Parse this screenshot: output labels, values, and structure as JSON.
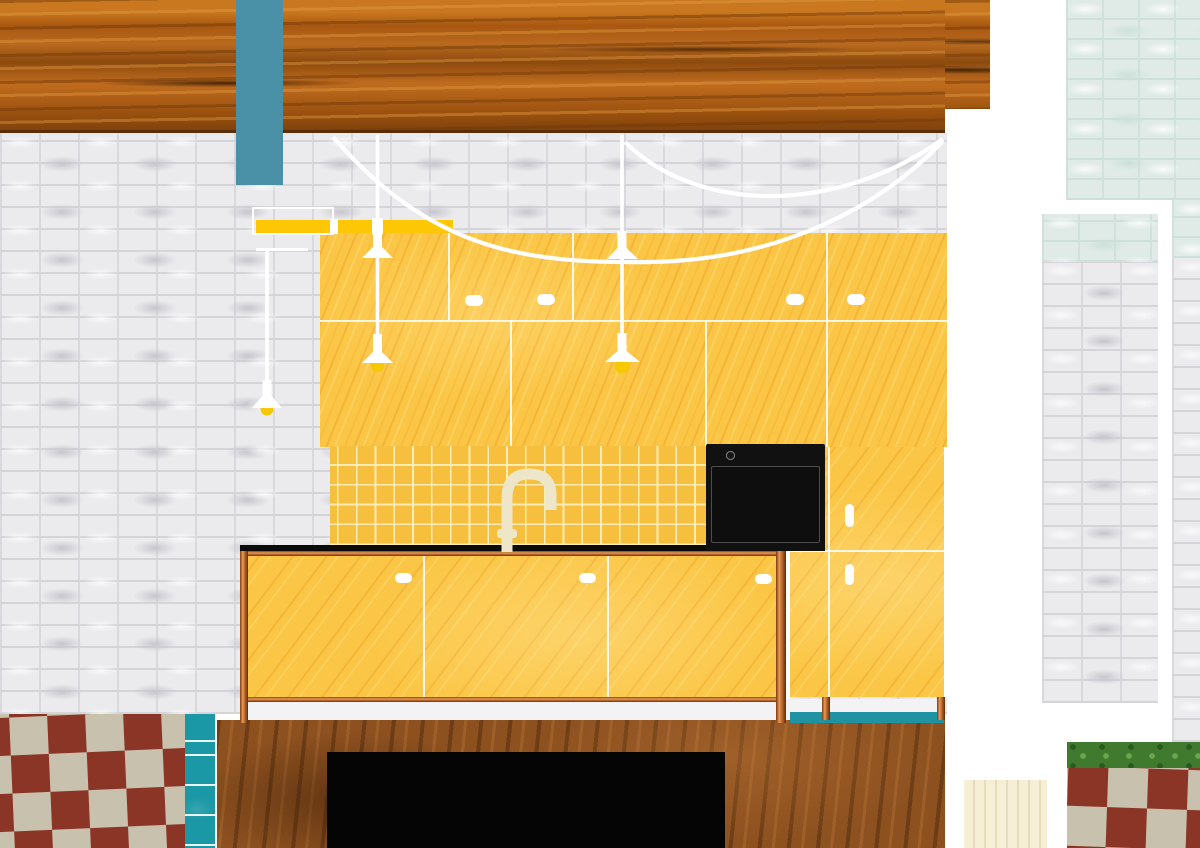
{
  "title": "Kitchen interior elevation collage",
  "palette": {
    "white": "#ffffff",
    "brick_bg": "#ebebee",
    "brick_line": "#d4d4d9",
    "brick_shadow": "#c6c6cd",
    "mint_bg": "#e0ebe7",
    "mint_line": "#cde0da",
    "beam_base": "#b2611a",
    "beam_dark": "#7c3f0b",
    "beam_edge": "#5a2f08",
    "teal_bar": "#4a90a6",
    "teal_tile": "#1b98a6",
    "teal_base": "#1f93a1",
    "ply": "#fbc645",
    "ply_grain": "#eea22c",
    "tile_yellow": "#f6bf3e",
    "grout": "#fdedb4",
    "rail_yellow": "#fdc705",
    "counter_black": "#0b0b0b",
    "copper": "#b5622a",
    "copper_light": "#e79a55",
    "oven_black": "#111111",
    "knob_ring": "#787878",
    "island_base": "#8d5120",
    "check_red": "#8b3526",
    "check_bone": "#c8c1ae",
    "green": "#3f7a2e",
    "green_dark": "#2a5a1e",
    "cream": "#f6efd6",
    "plinth": "#f3f3f5",
    "faucet": "#ede6c8",
    "cord_white": "#ffffff",
    "bulb_yellow": "#f6c800"
  },
  "scene": {
    "pendant_count": 3,
    "oven_knobs": 6,
    "upper_cabinet_handles": 4,
    "base_cabinet_doors": 3,
    "base_cabinet_handles": 3,
    "tall_cabinet_handles": 2,
    "floor_left": "red and bone checkerboard tiles",
    "floor_right": "red and bone checkerboard tiles with hedge strip",
    "wall": "white painted brick",
    "accent_wall": "mint painted brick columns",
    "cabinet_material": "yellow pine plywood",
    "counter_frame": "copper-stained wood",
    "appliance": "black oven with six knobs"
  }
}
